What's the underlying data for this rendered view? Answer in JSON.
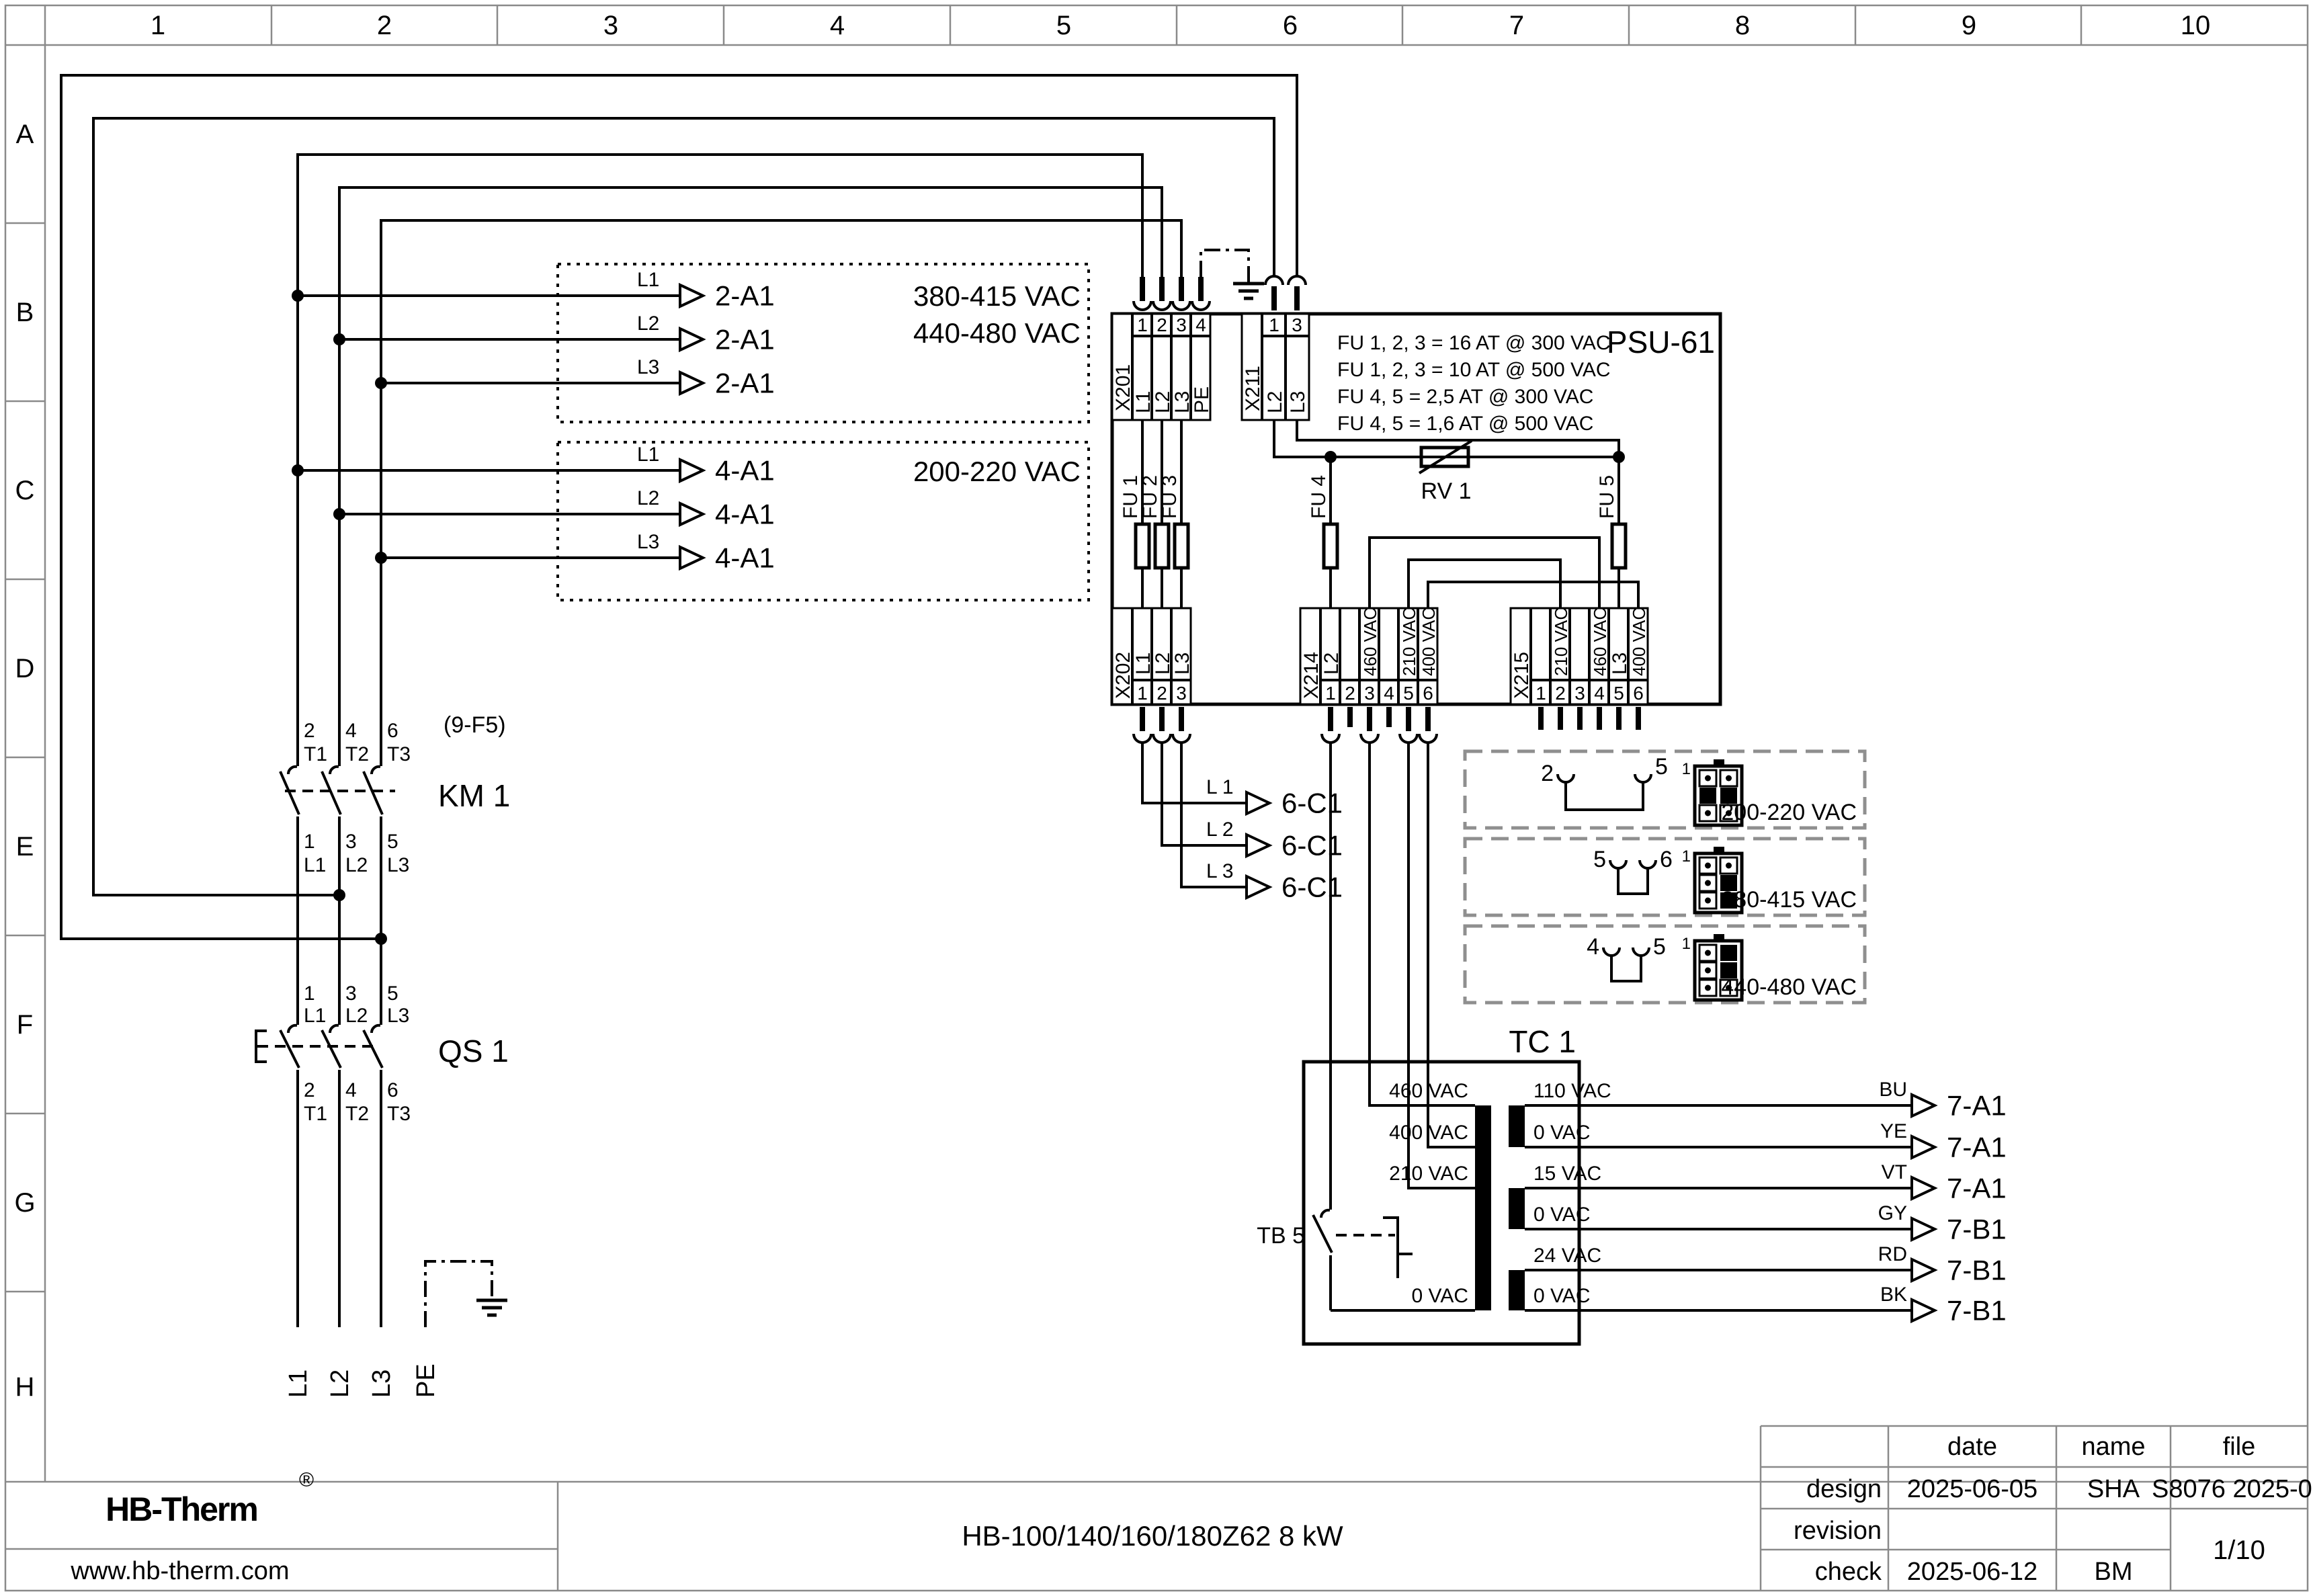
{
  "colors": {
    "brand_navy": "#13254d",
    "line": "#000000",
    "grid_line": "#8a8a8a"
  },
  "grid": {
    "cols": [
      "1",
      "2",
      "3",
      "4",
      "5",
      "6",
      "7",
      "8",
      "9",
      "10"
    ],
    "rows": [
      "A",
      "B",
      "C",
      "D",
      "E",
      "F",
      "G",
      "H"
    ]
  },
  "incoming": {
    "labels": [
      "L1",
      "L2",
      "L3",
      "PE"
    ]
  },
  "qs1": {
    "name": "QS 1",
    "top_pins": [
      "1",
      "3",
      "5"
    ],
    "top_labels": [
      "L1",
      "L2",
      "L3"
    ],
    "bottom_pins": [
      "2",
      "4",
      "6"
    ],
    "bottom_labels": [
      "T1",
      "T2",
      "T3"
    ]
  },
  "km1": {
    "name": "KM 1",
    "ref": "(9-F5)",
    "top_pins": [
      "2",
      "4",
      "6"
    ],
    "top_labels": [
      "T1",
      "T2",
      "T3"
    ],
    "bottom_pins": [
      "1",
      "3",
      "5"
    ],
    "bottom_labels": [
      "L1",
      "L2",
      "L3"
    ]
  },
  "feed_box_hv": {
    "volt_range_1": "380-415 VAC",
    "volt_range_2": "440-480 VAC",
    "lines": [
      {
        "phase": "L1",
        "dest": "2-A1"
      },
      {
        "phase": "L2",
        "dest": "2-A1"
      },
      {
        "phase": "L3",
        "dest": "2-A1"
      }
    ]
  },
  "feed_box_lv": {
    "volt_range": "200-220 VAC",
    "lines": [
      {
        "phase": "L1",
        "dest": "4-A1"
      },
      {
        "phase": "L2",
        "dest": "4-A1"
      },
      {
        "phase": "L3",
        "dest": "4-A1"
      }
    ]
  },
  "psu": {
    "name": "PSU-61",
    "notes": [
      "FU 1, 2, 3 = 16 AT @ 300 VAC",
      "FU 1, 2, 3 = 10 AT @ 500 VAC",
      "FU 4, 5 = 2,5 AT @ 300 VAC",
      "FU 4, 5 = 1,6 AT @ 500 VAC"
    ],
    "x201": {
      "name": "X201",
      "pins": [
        "1",
        "2",
        "3",
        "4"
      ],
      "labels": [
        "L1",
        "L2",
        "L3",
        "PE"
      ]
    },
    "x211": {
      "name": "X211",
      "pins": [
        "1",
        "3"
      ],
      "labels": [
        "L2",
        "L3"
      ]
    },
    "x202": {
      "name": "X202",
      "pins": [
        "1",
        "2",
        "3"
      ],
      "labels": [
        "L1",
        "L2",
        "L3"
      ]
    },
    "x214": {
      "name": "X214",
      "pins": [
        "1",
        "2",
        "3",
        "4",
        "5",
        "6"
      ],
      "labels": [
        "L2",
        "",
        "460 VAC",
        "",
        "210 VAC",
        "400 VAC"
      ]
    },
    "x215": {
      "name": "X215",
      "pins": [
        "1",
        "2",
        "3",
        "4",
        "5",
        "6"
      ],
      "labels": [
        "",
        "210 VAC",
        "",
        "460 VAC",
        "L3",
        "400 VAC"
      ]
    },
    "fuses": {
      "fu1": "FU 1",
      "fu2": "FU 2",
      "fu3": "FU 3",
      "fu4": "FU 4",
      "fu5": "FU 5"
    },
    "rv1": "RV 1"
  },
  "control_out": {
    "lines": [
      {
        "phase": "L 1",
        "dest": "6-C1"
      },
      {
        "phase": "L 2",
        "dest": "6-C1"
      },
      {
        "phase": "L 3",
        "dest": "6-C1"
      }
    ]
  },
  "voltage_options": [
    {
      "jumper_a": "2",
      "jumper_b": "5",
      "pin1": "1",
      "label": "200-220 VAC"
    },
    {
      "jumper_a": "5",
      "jumper_b": "6",
      "pin1": "1",
      "label": "380-415 VAC"
    },
    {
      "jumper_a": "4",
      "jumper_b": "5",
      "pin1": "1",
      "label": "440-480 VAC"
    }
  ],
  "tc1": {
    "name": "TC 1",
    "tb5": "TB 5",
    "primary_taps": [
      "460 VAC",
      "400 VAC",
      "210 VAC",
      "0 VAC"
    ],
    "secondary_taps": [
      "110 VAC",
      "0 VAC",
      "15 VAC",
      "0 VAC",
      "24 VAC",
      "0 VAC"
    ],
    "outputs": [
      {
        "color": "BU",
        "dest": "7-A1"
      },
      {
        "color": "YE",
        "dest": "7-A1"
      },
      {
        "color": "VT",
        "dest": "7-A1"
      },
      {
        "color": "GY",
        "dest": "7-B1"
      },
      {
        "color": "RD",
        "dest": "7-B1"
      },
      {
        "color": "BK",
        "dest": "7-B1"
      }
    ]
  },
  "title_block": {
    "logo_text": "HB-Therm",
    "logo_reg": "®",
    "website": "www.hb-therm.com",
    "drawing_title": "HB-100/140/160/180Z62 8 kW",
    "col_date": "date",
    "col_name": "name",
    "col_file": "file",
    "row_design": "design",
    "row_revision": "revision",
    "row_check": "check",
    "design_date": "2025-06-05",
    "design_name": "SHA",
    "file_id": "S8076 2025-06",
    "check_date": "2025-06-12",
    "check_name": "BM",
    "page": "1/10"
  }
}
